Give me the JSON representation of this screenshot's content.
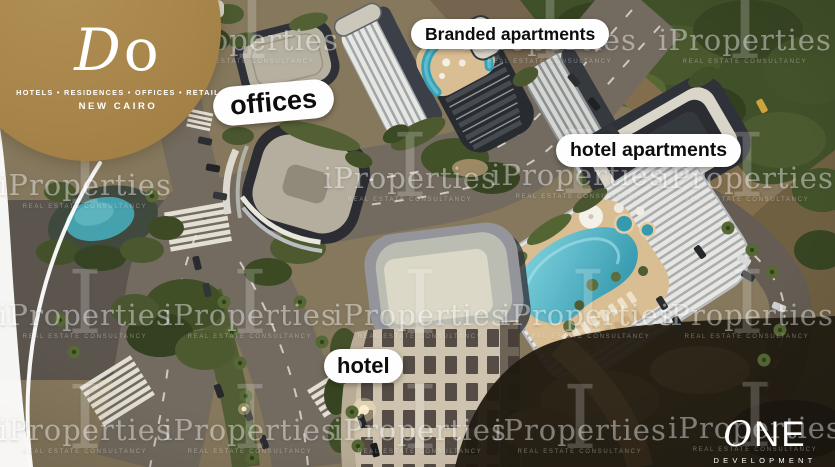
{
  "brand_badge": {
    "wordmark": "Do",
    "tagline": "HOTELS • RESIDENCES • OFFICES • RETAIL",
    "location": "NEW CAIRO",
    "bg_color": "#a8854a"
  },
  "labels": {
    "branded_apartments": "Branded apartments",
    "offices": "offices",
    "hotel_apartments": "hotel apartments",
    "hotel": "hotel"
  },
  "watermark": {
    "initial": "I",
    "name": "iProperties",
    "tagline": "REAL ESTATE CONSULTANCY",
    "positions": [
      [
        252,
        62
      ],
      [
        550,
        62
      ],
      [
        745,
        62
      ],
      [
        85,
        207
      ],
      [
        410,
        200
      ],
      [
        578,
        197
      ],
      [
        747,
        200
      ],
      [
        85,
        337
      ],
      [
        250,
        337
      ],
      [
        420,
        337
      ],
      [
        588,
        337
      ],
      [
        747,
        337
      ],
      [
        85,
        452
      ],
      [
        250,
        452
      ],
      [
        420,
        452
      ],
      [
        580,
        452
      ],
      [
        755,
        450
      ]
    ]
  },
  "developer_logo": {
    "name": "ONE",
    "subtitle": "DEVELOPMENT"
  },
  "colors": {
    "brand_gold": "#a8854a",
    "pool_teal": "#2f9fb7",
    "label_background": "#ffffff",
    "label_text": "#0d0d0d",
    "watermark_white": "#ffffff"
  }
}
